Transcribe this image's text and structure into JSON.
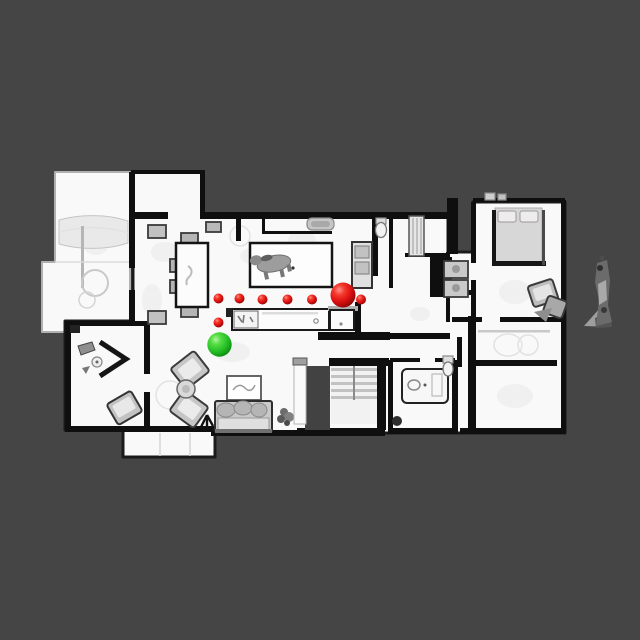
{
  "scene": {
    "type": "topdown-navigation-map",
    "background_color": "#454545",
    "floor_color": "#f9f9f9",
    "wall_color": "#0f0f0f",
    "markers": {
      "start": {
        "name": "start-position",
        "x": 219.5,
        "y": 344.5,
        "r": 12.2,
        "color": "#2ec82e"
      },
      "goal": {
        "name": "goal-position",
        "x": 343.0,
        "y": 295.0,
        "r": 12.5,
        "color": "#e01212"
      },
      "waypoint_color": "#e01212",
      "waypoint_radius": 5.0,
      "waypoints": [
        {
          "x": 218.5,
          "y": 298.5
        },
        {
          "x": 239.5,
          "y": 298.5
        },
        {
          "x": 262.5,
          "y": 299.5
        },
        {
          "x": 287.5,
          "y": 299.5
        },
        {
          "x": 312.0,
          "y": 299.5
        },
        {
          "x": 361.0,
          "y": 299.5
        },
        {
          "x": 218.5,
          "y": 322.5
        }
      ]
    }
  }
}
